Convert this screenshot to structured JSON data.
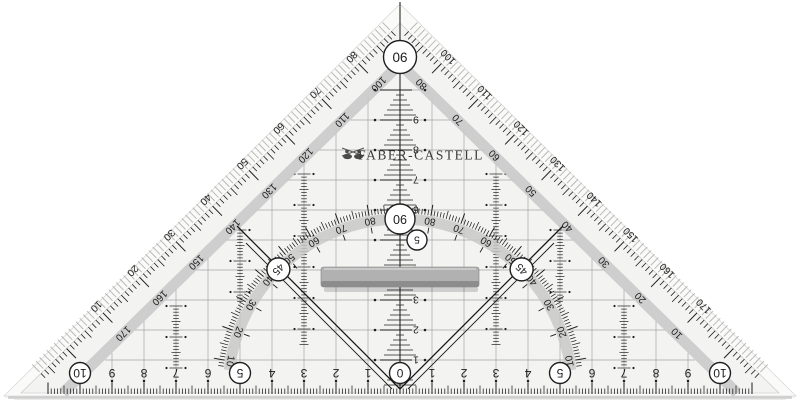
{
  "brand": {
    "name": "FABER-CASTELL",
    "logo_icon": "jousting-knights-icon"
  },
  "apex_badge": "90",
  "arc": {
    "degree_labels": [
      "10",
      "20",
      "30",
      "40",
      "50",
      "60",
      "70",
      "80"
    ],
    "circled_45": "45",
    "circled_90": "90"
  },
  "edges": {
    "left_outer": [
      "80",
      "70",
      "60",
      "50",
      "40",
      "30",
      "20",
      "10"
    ],
    "left_inner": [
      "100",
      "110",
      "120",
      "130",
      "140",
      "150",
      "160",
      "170"
    ],
    "right_outer": [
      "100",
      "110",
      "120",
      "130",
      "140",
      "150",
      "160",
      "170"
    ],
    "right_inner": [
      "80",
      "70",
      "60",
      "50",
      "40",
      "30",
      "20",
      "10"
    ]
  },
  "bottom_ruler": {
    "unit": "cm",
    "center": "0",
    "numbers": [
      "1",
      "2",
      "3",
      "4",
      "5",
      "6",
      "7",
      "8",
      "9",
      "10"
    ],
    "circled": [
      "0",
      "5",
      "10"
    ]
  },
  "vertical_ruler": {
    "numbers": [
      "1",
      "2",
      "3",
      "4",
      "5",
      "6",
      "7",
      "8",
      "9"
    ],
    "circled": "5"
  },
  "colors": {
    "face": "#f3f3f2",
    "bevel": "#fafaf9",
    "band": "#c8c8c8",
    "ink": "#1f1f1f",
    "grid": "#98989c",
    "hatch": "#b2b2b2",
    "grip": "#b1b1b1",
    "grip_dark": "#8d8d8d",
    "shadow": "#d8d8d8"
  }
}
